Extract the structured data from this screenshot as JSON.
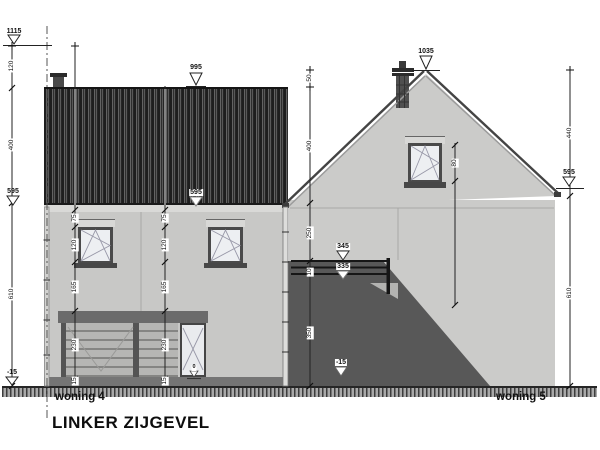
{
  "title": "LINKER ZIJGEVEL",
  "buildings": {
    "left": "woning 4",
    "right": "woning 5"
  },
  "levels": {
    "chimney_top_left": "1115",
    "roof_left": "995",
    "floor_left": "595",
    "floor_center": "595",
    "eaves_right": "595",
    "ridge": "1035",
    "rail_top": "345",
    "wall_top": "335",
    "ground_left": "-15",
    "ground_center": "-15",
    "door_floor": "0"
  },
  "dims": {
    "left_chain": [
      "120",
      "400",
      "610"
    ],
    "mid_chain": [
      "50",
      "400",
      "250",
      "10",
      "350"
    ],
    "right_chain": [
      "440",
      "610"
    ],
    "facade_chain_a": [
      "75",
      "120",
      "165",
      "230",
      "15"
    ],
    "facade_chain_b": [
      "75",
      "120",
      "165",
      "230",
      "15"
    ],
    "window_right": "80"
  },
  "colors": {
    "wall_left": "#c8c8c6",
    "wall_right": "#cbcbc9",
    "siding": "#2a2a2a",
    "shadow": "#585858",
    "frame": "#4a4a4a",
    "ground_hatch": "#a9a9a9"
  }
}
